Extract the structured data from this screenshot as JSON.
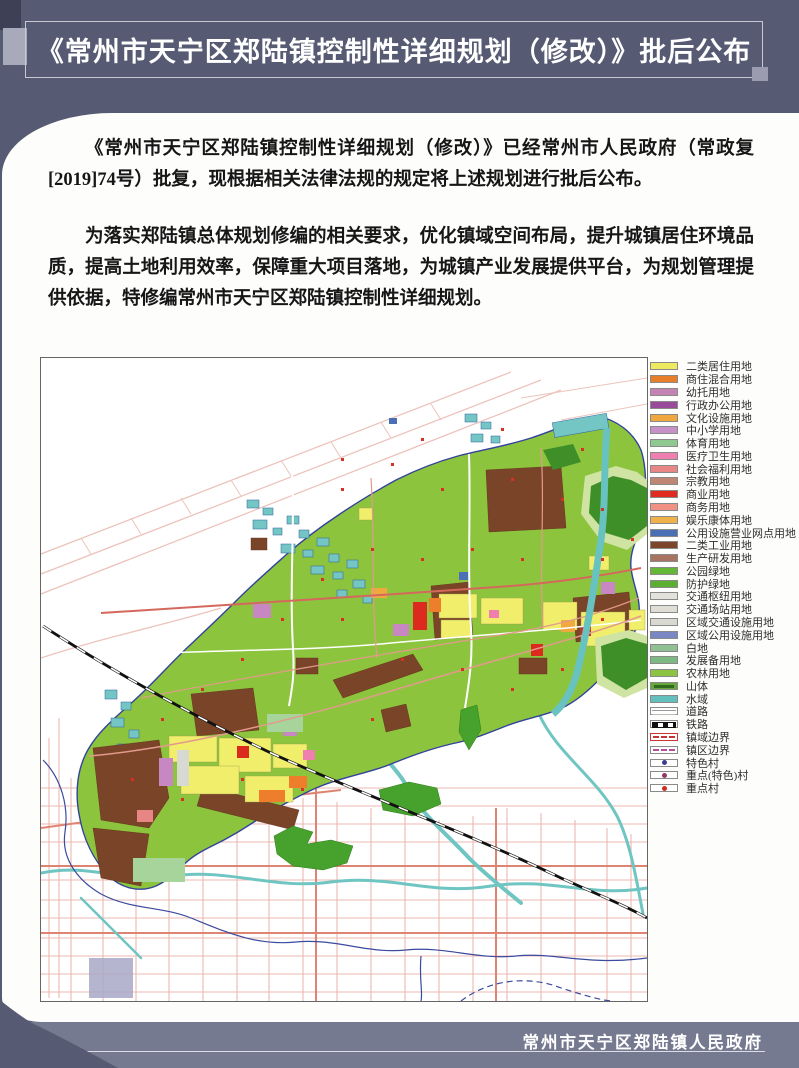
{
  "page": {
    "background": "#565a72",
    "accent_dark": "#3e4156",
    "accent_light": "#a9a9bc",
    "accent_mid": "#9c9cb0",
    "footer_bar": "#767a90"
  },
  "header": {
    "title": "《常州市天宁区郑陆镇控制性详细规划（修改）》批后公布"
  },
  "body": {
    "paragraph1": "《常州市天宁区郑陆镇控制性详细规划（修改）》已经常州市人民政府（常政复[2019]74号）批复，现根据相关法律法规的规定将上述规划进行批后公布。",
    "paragraph2": "为落实郑陆镇总体规划修编的相关要求，优化镇域空间布局，提升城镇居住环境品质，提高土地利用效率，保障重大项目落地，为城镇产业发展提供平台，为规划管理提供依据，特修编常州市天宁区郑陆镇控制性详细规划。"
  },
  "legend": {
    "items": [
      {
        "label": "二类居住用地",
        "type": "fill",
        "color": "#eeea60"
      },
      {
        "label": "商住混合用地",
        "type": "fill",
        "color": "#e77e2a"
      },
      {
        "label": "幼托用地",
        "type": "fill",
        "color": "#c583b5"
      },
      {
        "label": "行政办公用地",
        "type": "fill",
        "color": "#9a4a9a"
      },
      {
        "label": "文化设施用地",
        "type": "fill",
        "color": "#f0a83e"
      },
      {
        "label": "中小学用地",
        "type": "fill",
        "color": "#c791c7"
      },
      {
        "label": "体育用地",
        "type": "fill",
        "color": "#8fc98f"
      },
      {
        "label": "医疗卫生用地",
        "type": "fill",
        "color": "#ef7fae"
      },
      {
        "label": "社会福利用地",
        "type": "fill",
        "color": "#e88585"
      },
      {
        "label": "宗教用地",
        "type": "fill",
        "color": "#bf8673"
      },
      {
        "label": "商业用地",
        "type": "fill",
        "color": "#e0291f"
      },
      {
        "label": "商务用地",
        "type": "fill",
        "color": "#f09184"
      },
      {
        "label": "娱乐康体用地",
        "type": "fill",
        "color": "#f0b14a"
      },
      {
        "label": "公用设施营业网点用地",
        "type": "fill",
        "color": "#4a6fb5"
      },
      {
        "label": "二类工业用地",
        "type": "fill",
        "color": "#7d452a"
      },
      {
        "label": "生产研发用地",
        "type": "fill",
        "color": "#a97362"
      },
      {
        "label": "公园绿地",
        "type": "fill",
        "color": "#66b637"
      },
      {
        "label": "防护绿地",
        "type": "fill",
        "color": "#5cae31"
      },
      {
        "label": "交通枢纽用地",
        "type": "fill",
        "color": "#e2e2da"
      },
      {
        "label": "交通场站用地",
        "type": "fill",
        "color": "#deded6"
      },
      {
        "label": "区域交通设施用地",
        "type": "fill",
        "color": "#d9d9d1"
      },
      {
        "label": "区域公用设施用地",
        "type": "fill",
        "color": "#7a87c5"
      },
      {
        "label": "白地",
        "type": "fill",
        "color": "#8fbf92"
      },
      {
        "label": "发展备用地",
        "type": "fill",
        "color": "#7db983"
      },
      {
        "label": "农林用地",
        "type": "fill",
        "color": "#8cc340"
      },
      {
        "label": "山体",
        "type": "mountain",
        "color": "#66a83a",
        "color2": "#2e6b1c"
      },
      {
        "label": "水域",
        "type": "fill",
        "color": "#62bfbc"
      },
      {
        "label": "道路",
        "type": "road",
        "color": "#888888"
      },
      {
        "label": "铁路",
        "type": "rail",
        "color": "#111111"
      },
      {
        "label": "镇域边界",
        "type": "boundary",
        "color": "#c63434"
      },
      {
        "label": "镇区边界",
        "type": "boundary2",
        "color": "#b0529b"
      },
      {
        "label": "特色村",
        "type": "dot",
        "color": "#3d3d8f"
      },
      {
        "label": "重点(特色)村",
        "type": "dot",
        "color": "#8f3a63"
      },
      {
        "label": "重点村",
        "type": "dot",
        "color": "#d02a20"
      }
    ]
  },
  "footer": {
    "text": "常州市天宁区郑陆镇人民政府"
  }
}
